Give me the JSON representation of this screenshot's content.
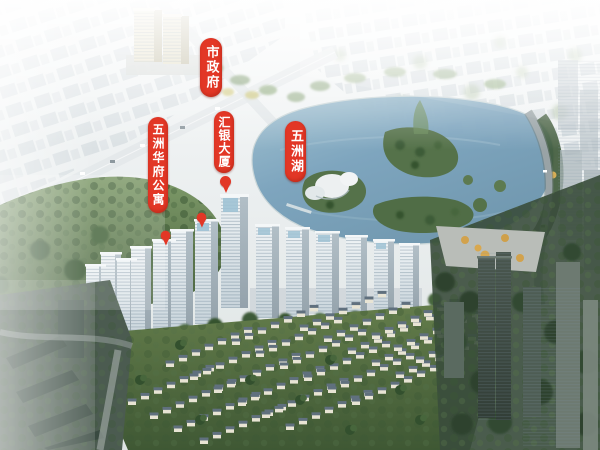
{
  "scene": {
    "type": "aerial-masterplan-rendering",
    "subject": "lakeside residential development bird's-eye view"
  },
  "annotations": {
    "city_government": {
      "label": "市政府"
    },
    "huiyin_tower": {
      "label": "汇银大厦",
      "pins": 1
    },
    "wuzhou_huafu_apartments": {
      "label": "五洲华府公寓",
      "pins": 2
    },
    "wuzhou_lake": {
      "label": "五洲湖"
    }
  },
  "colors": {
    "label_red": "#e23726",
    "label_text": "#ffffff",
    "lake_water": "#7ba3bd",
    "island_green": "#55724a",
    "forest_green": "#46643c",
    "tower_facade": "#e3ebf0",
    "glass_crown": "#9fc2d4",
    "villa_wall": "#e8e4d4",
    "villa_roof": "#60707e",
    "dark_tower": "#3f4c44",
    "haze_white": "#f4f7f7"
  }
}
